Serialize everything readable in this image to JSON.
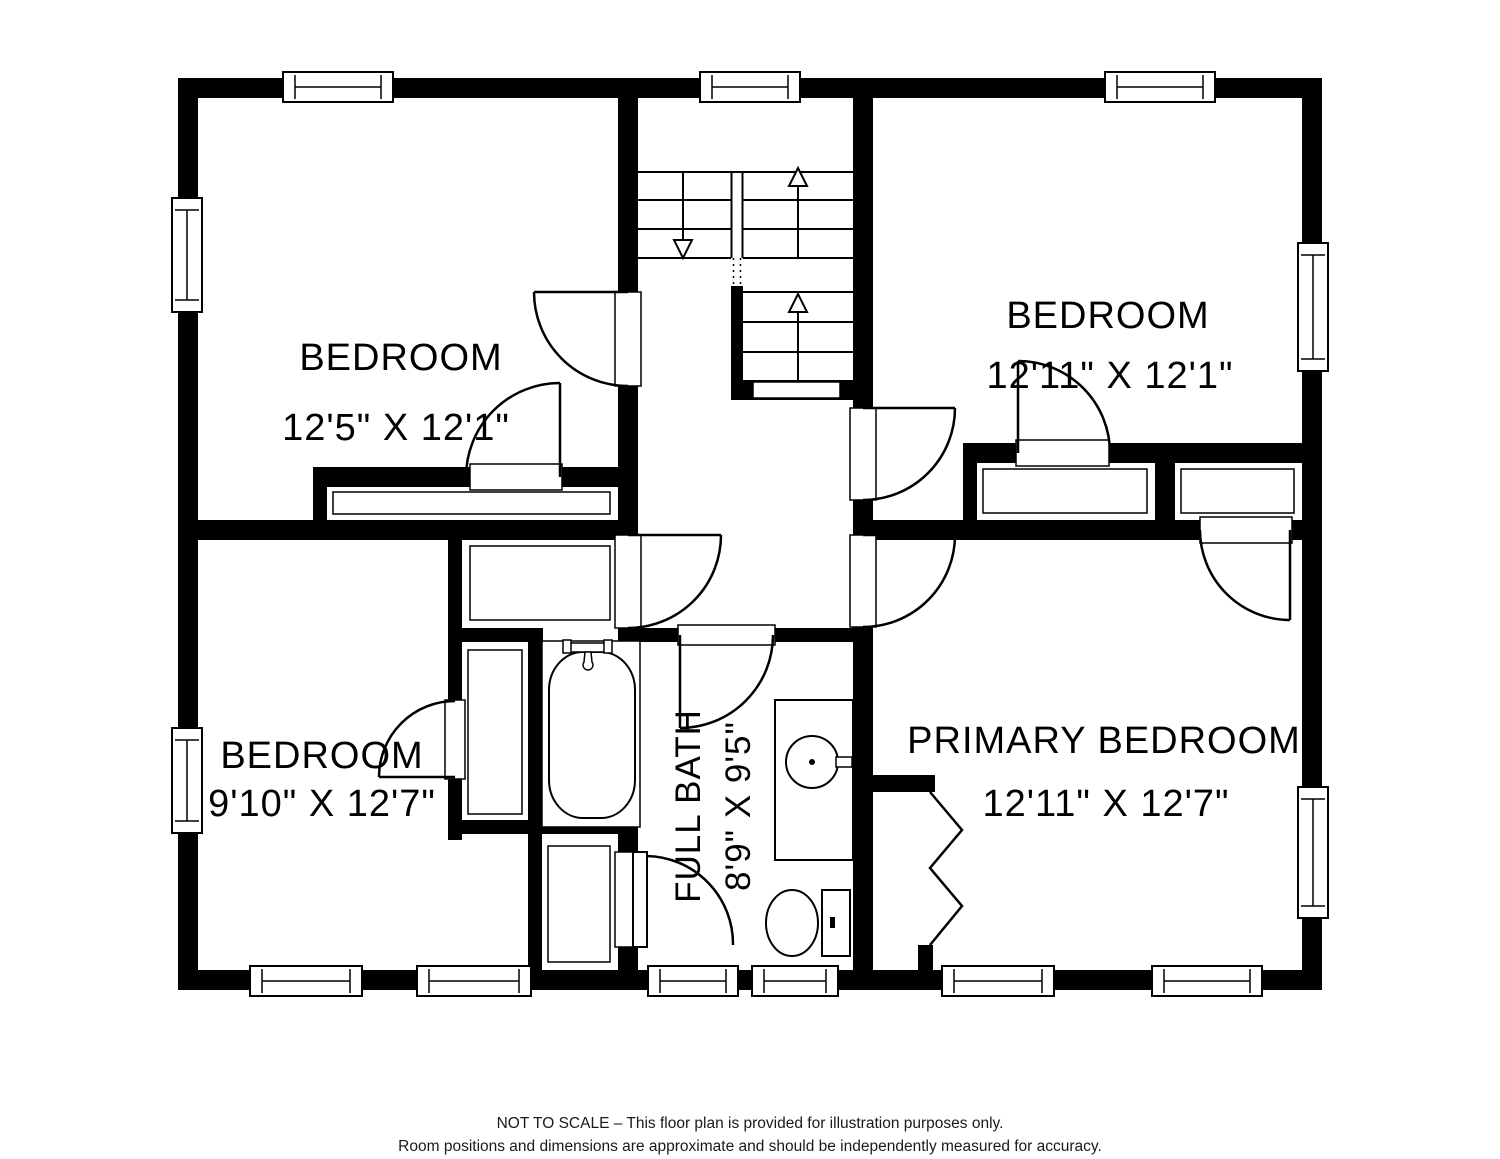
{
  "meta": {
    "title": "Second floor plan",
    "colors": {
      "wall": "#000000",
      "background": "#ffffff",
      "line": "#000000"
    }
  },
  "rooms": {
    "tl": {
      "name": "BEDROOM",
      "dims": "12'5\" X 12'1\""
    },
    "tr": {
      "name": "BEDROOM",
      "dims": "12'11\" X 12'1\""
    },
    "bl": {
      "name": "BEDROOM",
      "dims": "9'10\" X 12'7\""
    },
    "bath": {
      "name": "FULL BATH",
      "dims": "8'9\" X 9'5\""
    },
    "primary": {
      "name": "PRIMARY BEDROOM",
      "dims": "12'11\" X 12'7\""
    }
  },
  "stairs": {
    "up_arrow_icon": "arrow-up",
    "down_arrow_icon": "arrow-down"
  },
  "fixtures": {
    "bathtub_icon": "bathtub",
    "vanity_sink_icon": "sink",
    "toilet_icon": "toilet"
  },
  "caption": {
    "line1": "NOT TO SCALE – This floor plan is provided for illustration purposes only.",
    "line2": "Room positions and dimensions are approximate and should be independently measured for accuracy."
  }
}
